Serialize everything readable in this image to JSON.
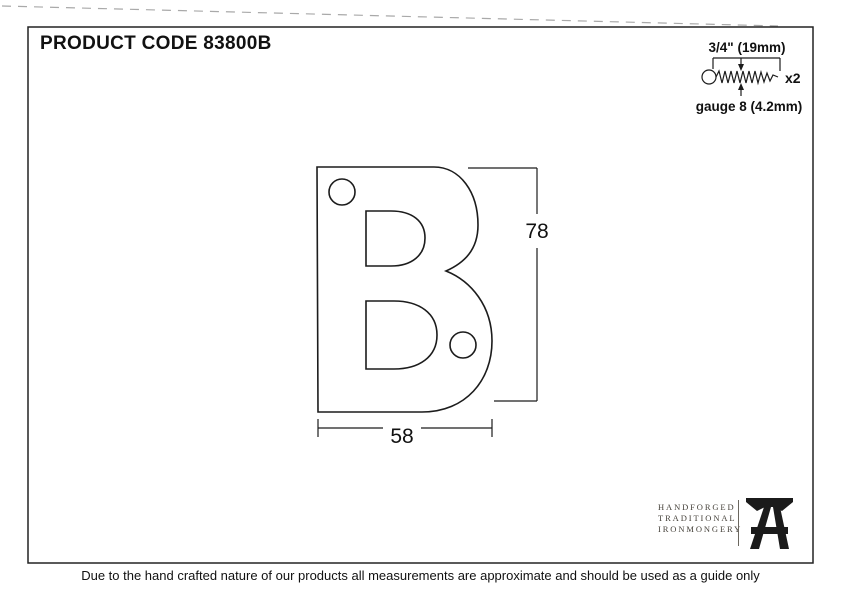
{
  "header": {
    "product_code_label": "PRODUCT CODE 83800B"
  },
  "screw": {
    "length_label": "3/4\" (19mm)",
    "gauge_label": "gauge 8 (4.2mm)",
    "quantity_label": "x2"
  },
  "drawing": {
    "letter": "B",
    "height_label": "78",
    "width_label": "58"
  },
  "brand": {
    "lines": [
      "HANDFORGED",
      "TRADITIONAL",
      "IRONMONGERY"
    ]
  },
  "footer": {
    "disclaimer": "Due to the hand crafted nature of our products all measurements are approximate and should be used as a guide only"
  },
  "colors": {
    "ink": "#1c1c1c",
    "brand_text": "#45413a"
  }
}
